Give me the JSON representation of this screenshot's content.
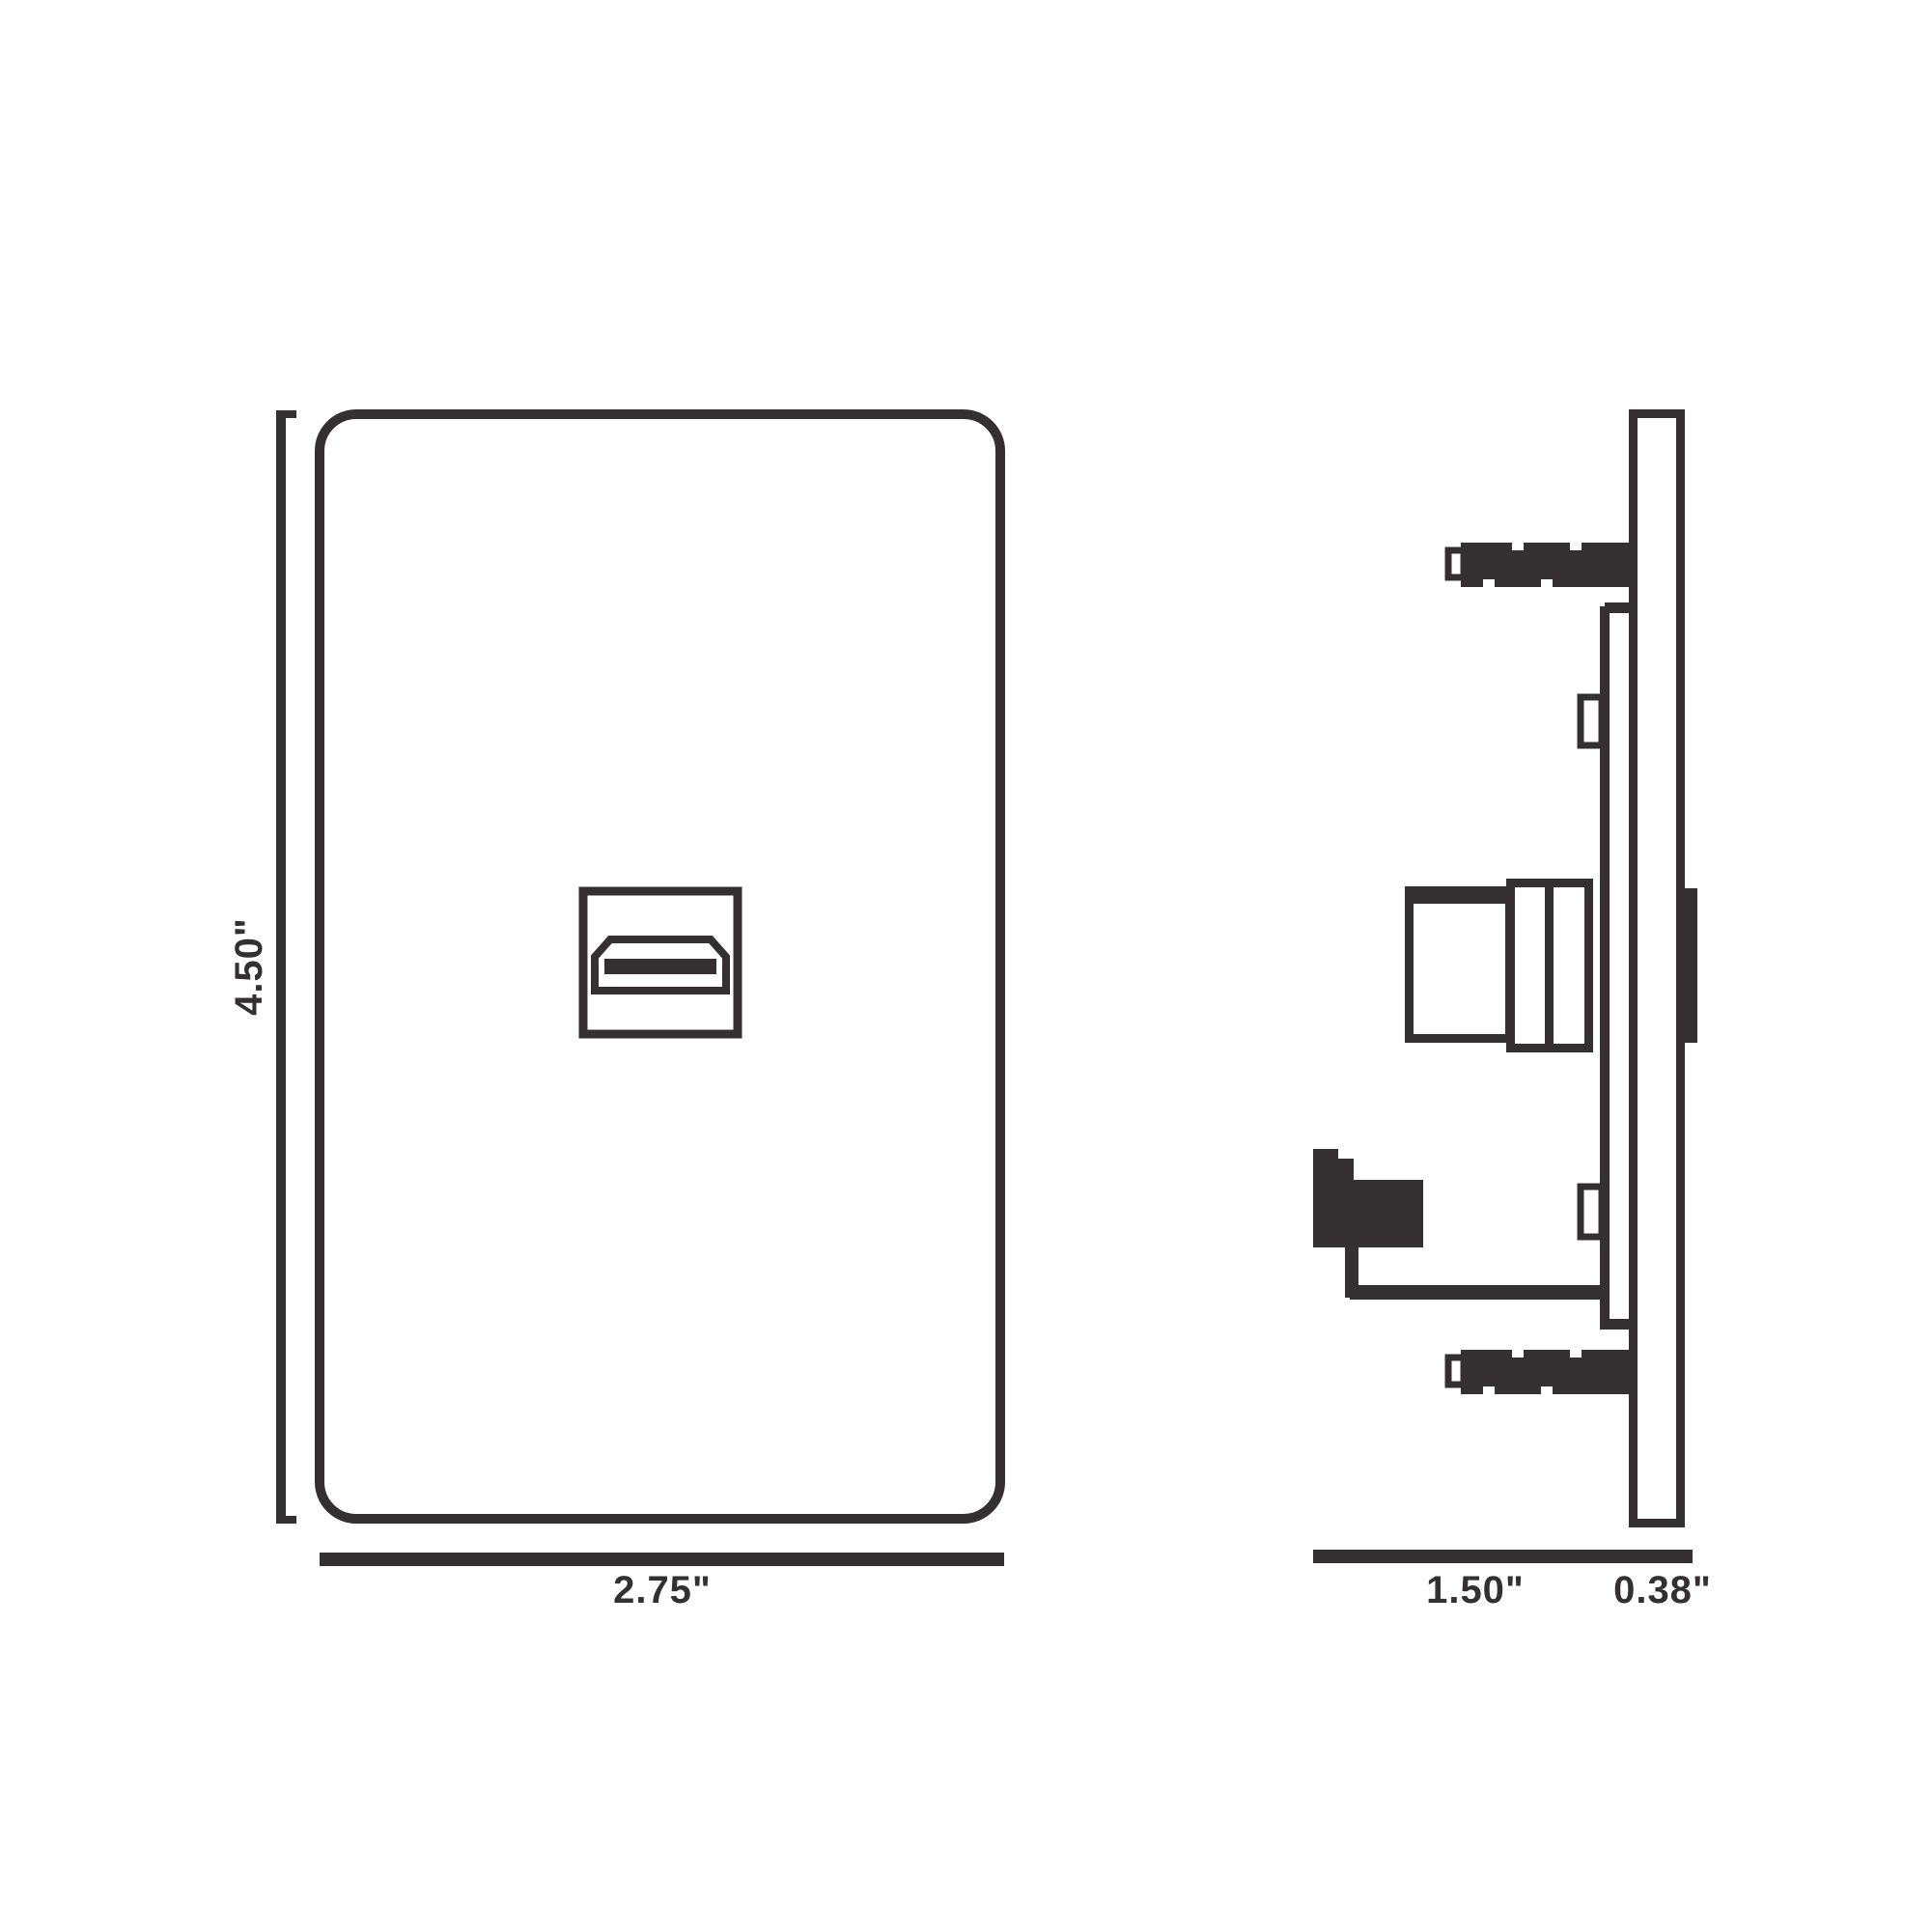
{
  "colors": {
    "line": "#343031",
    "background": "#ffffff"
  },
  "dimensions": {
    "front": {
      "height": "4.50\"",
      "width": "2.75\""
    },
    "side": {
      "depth": "1.50\"",
      "thickness": "0.38\""
    }
  }
}
